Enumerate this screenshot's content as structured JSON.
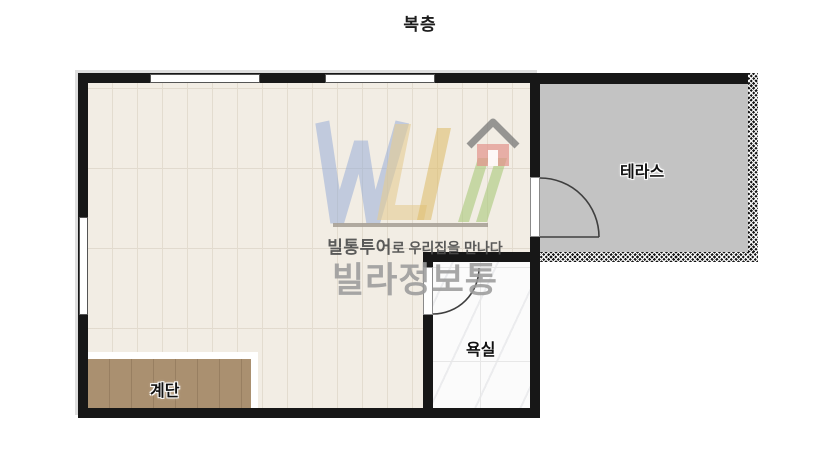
{
  "page": {
    "title": "복층",
    "background": "#ffffff"
  },
  "plan": {
    "wall_color": "#171717",
    "main_room": {
      "floor_color": "#f2ede4",
      "plank_line_color": "#e3dccf",
      "windows": [
        "top-left",
        "top-right",
        "left-side"
      ]
    },
    "terrace": {
      "label": "테라스",
      "floor_color": "#c3c3c3",
      "outer_wall_style": "hatched"
    },
    "bathroom": {
      "label": "욕실",
      "floor_color": "#fbfbfb"
    },
    "stairs": {
      "label": "계단",
      "fill_color": "#aa9070"
    },
    "doors": [
      "terrace-door-swing",
      "bathroom-door-swing"
    ]
  },
  "watermark": {
    "logo_letters": "WLI",
    "icons": [
      "villa-logo",
      "house-icon"
    ],
    "tagline_bold": "빌통투어",
    "tagline_rest": "로 우리집을 만나다",
    "brand": "빌라정보통",
    "colors": {
      "letter_w": "#8fa8d6",
      "letter_l": "#e5cc92",
      "letter_i": "#dcb964",
      "letter_green": "#a9c87a",
      "house_roof": "#777777",
      "house_body": "#e2938b",
      "divider": "#a59c93",
      "tagline_text": "#4e4e4e",
      "brand_text": "#9c9c9c"
    }
  }
}
